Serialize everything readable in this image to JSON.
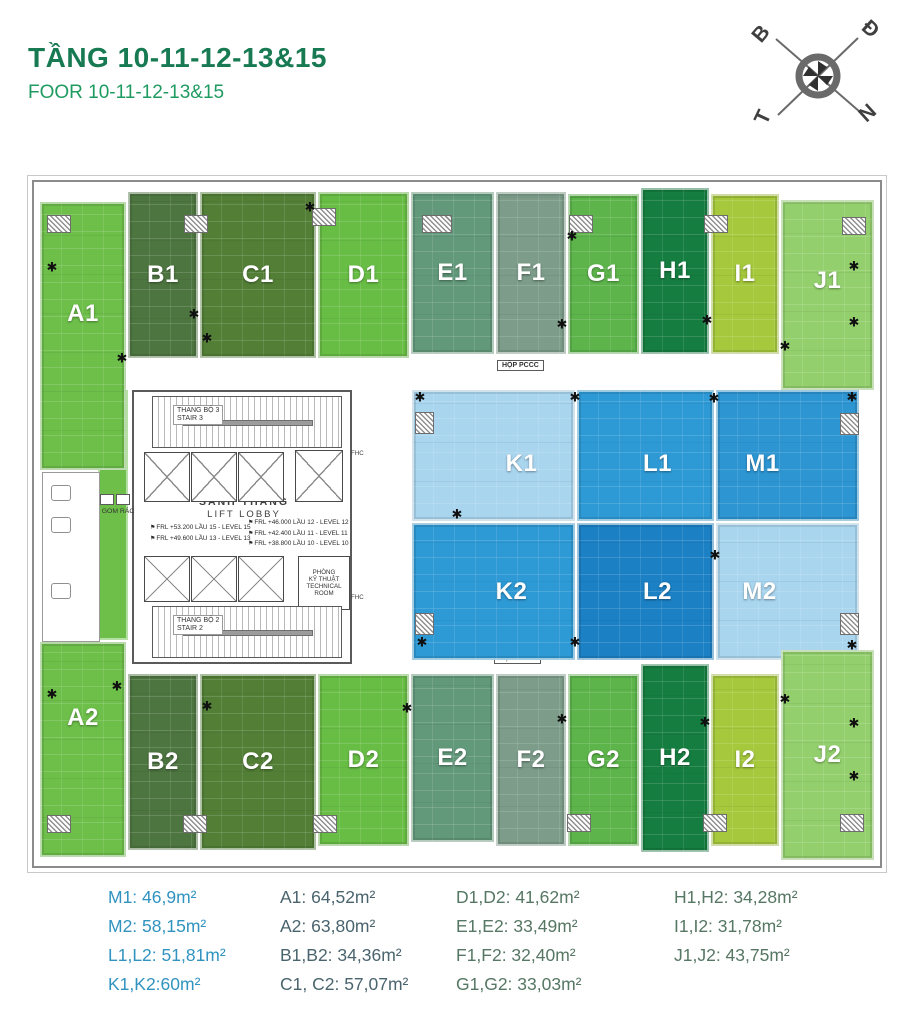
{
  "header": {
    "title": "TẦNG 10-11-12-13&15",
    "subtitle": "FOOR 10-11-12-13&15"
  },
  "compass": {
    "north": "B",
    "east": "Đ",
    "south": "N",
    "west": "T"
  },
  "floorplan": {
    "units": [
      {
        "id": "A1",
        "label": "A1",
        "x": 6,
        "y": 20,
        "w": 86,
        "h": 268,
        "fill": "#6dbf4a",
        "dy": -22
      },
      {
        "id": "B1",
        "label": "B1",
        "x": 94,
        "y": 10,
        "w": 70,
        "h": 166,
        "fill": "#4d7540"
      },
      {
        "id": "C1",
        "label": "C1",
        "x": 166,
        "y": 10,
        "w": 116,
        "h": 166,
        "fill": "#527e36"
      },
      {
        "id": "D1",
        "label": "D1",
        "x": 284,
        "y": 10,
        "w": 91,
        "h": 166,
        "fill": "#68bd45"
      },
      {
        "id": "E1",
        "label": "E1",
        "x": 377,
        "y": 10,
        "w": 83,
        "h": 162,
        "fill": "#62997b"
      },
      {
        "id": "F1",
        "label": "F1",
        "x": 462,
        "y": 10,
        "w": 70,
        "h": 162,
        "fill": "#7d9c8a"
      },
      {
        "id": "G1",
        "label": "G1",
        "x": 534,
        "y": 12,
        "w": 71,
        "h": 160,
        "fill": "#5cb44a"
      },
      {
        "id": "H1",
        "label": "H1",
        "x": 607,
        "y": 6,
        "w": 68,
        "h": 166,
        "fill": "#157d40"
      },
      {
        "id": "I1",
        "label": "I1",
        "x": 677,
        "y": 12,
        "w": 68,
        "h": 160,
        "fill": "#a5c83c"
      },
      {
        "id": "J1",
        "label": "J1",
        "x": 747,
        "y": 18,
        "w": 93,
        "h": 190,
        "fill": "#93d06d",
        "dy": -14
      },
      {
        "id": "K1",
        "label": "K1",
        "x": 378,
        "y": 208,
        "w": 163,
        "h": 131,
        "fill": "#a9d5ef",
        "dx": 28,
        "dy": 8
      },
      {
        "id": "L1",
        "label": "L1",
        "x": 543,
        "y": 208,
        "w": 137,
        "h": 131,
        "fill": "#2e9ad5",
        "dx": 12,
        "dy": 8
      },
      {
        "id": "M1",
        "label": "M1",
        "x": 682,
        "y": 208,
        "w": 143,
        "h": 131,
        "fill": "#2c95d2",
        "dx": -25,
        "dy": 8
      },
      {
        "id": "K2",
        "label": "K2",
        "x": 378,
        "y": 341,
        "w": 163,
        "h": 137,
        "fill": "#2e9ad5",
        "dx": 18
      },
      {
        "id": "L2",
        "label": "L2",
        "x": 543,
        "y": 341,
        "w": 137,
        "h": 137,
        "fill": "#1b80c4",
        "dx": 12
      },
      {
        "id": "M2",
        "label": "M2",
        "x": 682,
        "y": 341,
        "w": 143,
        "h": 137,
        "fill": "#a9d5ef",
        "dx": -28
      },
      {
        "id": "A2",
        "label": "A2",
        "x": 6,
        "y": 460,
        "w": 86,
        "h": 215,
        "fill": "#6dbf4a",
        "dy": -32
      },
      {
        "id": "B2",
        "label": "B2",
        "x": 94,
        "y": 492,
        "w": 70,
        "h": 176,
        "fill": "#4d7540"
      },
      {
        "id": "C2",
        "label": "C2",
        "x": 166,
        "y": 492,
        "w": 116,
        "h": 176,
        "fill": "#527e36"
      },
      {
        "id": "D2",
        "label": "D2",
        "x": 284,
        "y": 492,
        "w": 91,
        "h": 172,
        "fill": "#68bd45"
      },
      {
        "id": "E2",
        "label": "E2",
        "x": 377,
        "y": 492,
        "w": 83,
        "h": 168,
        "fill": "#62997b"
      },
      {
        "id": "F2",
        "label": "F2",
        "x": 462,
        "y": 492,
        "w": 70,
        "h": 172,
        "fill": "#7d9c8a"
      },
      {
        "id": "G2",
        "label": "G2",
        "x": 534,
        "y": 492,
        "w": 71,
        "h": 172,
        "fill": "#5cb44a"
      },
      {
        "id": "H2",
        "label": "H2",
        "x": 607,
        "y": 482,
        "w": 68,
        "h": 188,
        "fill": "#157d40"
      },
      {
        "id": "I2",
        "label": "I2",
        "x": 677,
        "y": 492,
        "w": 68,
        "h": 172,
        "fill": "#a5c83c"
      },
      {
        "id": "J2",
        "label": "J2",
        "x": 747,
        "y": 468,
        "w": 93,
        "h": 210,
        "fill": "#93d06d"
      }
    ],
    "core": {
      "stair3": [
        "THANG BỘ 3",
        "STAIR 3"
      ],
      "stair2": [
        "THANG BỘ 2",
        "STAIR 2"
      ],
      "lobby": [
        "SẢNH THANG",
        "LIFT LOBBY"
      ],
      "trash": "GOM RÁC",
      "technical": [
        "PHÒNG",
        "KỸ THUẬT",
        "TECHNICAL",
        "ROOM"
      ],
      "fhc": "FHC",
      "levels_left": [
        "FRL +53.200 LẦU 15 - LEVEL 15",
        "FRL +49.600 LẦU 13 - LEVEL 13"
      ],
      "levels_right": [
        "FRL +46.000 LẦU 12 - LEVEL 12",
        "FRL +42.400 LẦU 11 - LEVEL 11",
        "FRL +38.800 LẦU 10 - LEVEL 10"
      ]
    },
    "labels": {
      "pccc": "HỘP PCCC",
      "dimension": "900"
    }
  },
  "legend": {
    "columns": [
      {
        "color": "#3093c0",
        "items": [
          "M1: 46,9m²",
          "M2: 58,15m²",
          "L1,L2: 51,81m²",
          "K1,K2:60m²"
        ]
      },
      {
        "color": "#4a646e",
        "items": [
          "A1: 64,52m²",
          "A2: 63,80m²",
          "B1,B2: 34,36m²",
          "C1, C2: 57,07m²"
        ]
      },
      {
        "color": "#567763",
        "items": [
          "D1,D2: 41,62m²",
          "E1,E2: 33,49m²",
          "F1,F2: 32,40m²",
          "G1,G2: 33,03m²"
        ]
      },
      {
        "color": "#567763",
        "items": [
          "H1,H2: 34,28m²",
          "I1,I2: 31,78m²",
          "J1,J2: 43,75m²"
        ]
      }
    ]
  }
}
